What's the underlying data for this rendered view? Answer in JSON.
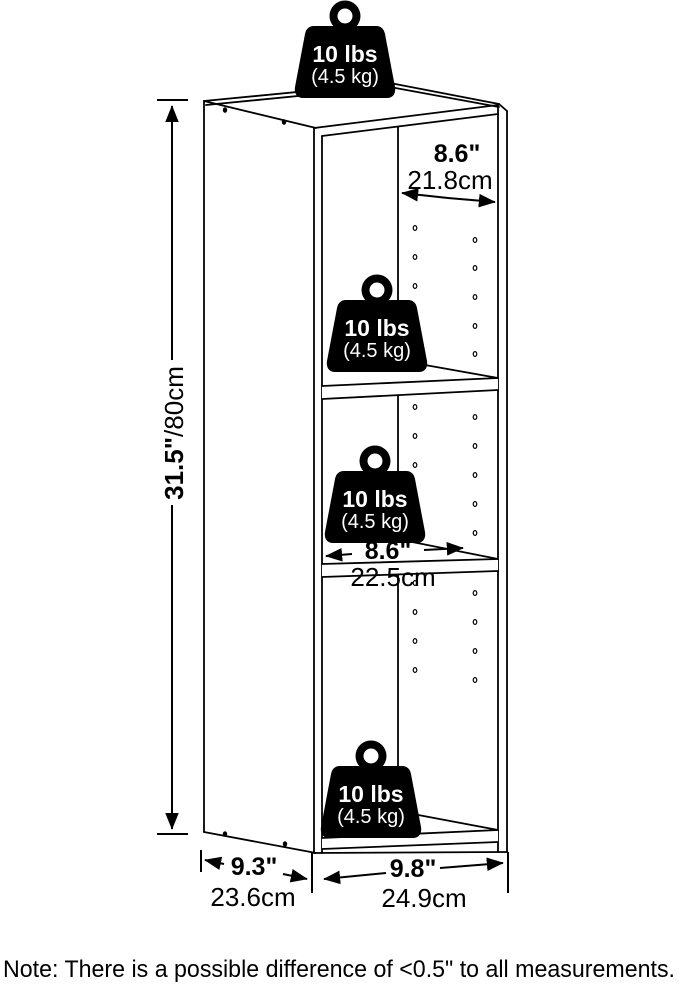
{
  "weight": {
    "lbs": "10 lbs",
    "kg": "(4.5 kg)"
  },
  "dimensions": {
    "height_in": "31.5\"",
    "height_cm": "/80cm",
    "top_width_in": "8.6\"",
    "top_width_cm": "21.8cm",
    "shelf_width_in": "8.6\"",
    "shelf_width_cm": "22.5cm",
    "depth_in": "9.3\"",
    "depth_cm": "23.6cm",
    "width_in": "9.8\"",
    "width_cm": "24.9cm"
  },
  "note": "Note: There is a possible difference of <0.5\" to all measurements.",
  "colors": {
    "line": "#000000",
    "background": "#ffffff",
    "weight_fill": "#000000",
    "weight_text": "#ffffff"
  }
}
